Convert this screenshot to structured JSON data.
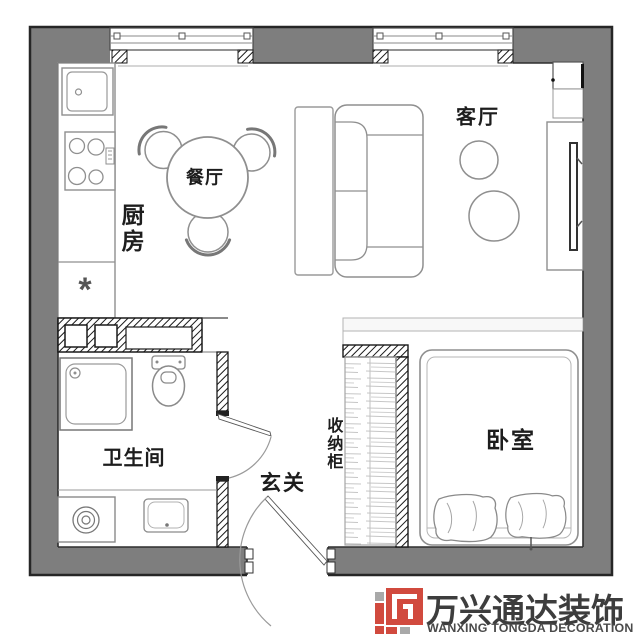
{
  "floorplan": {
    "rooms": {
      "dining": {
        "label": "餐厅"
      },
      "kitchen": {
        "label": "厨房",
        "orientation": "vertical"
      },
      "living": {
        "label": "客厅"
      },
      "bathroom": {
        "label": "卫生间"
      },
      "entry": {
        "label": "玄关"
      },
      "closet": {
        "label": "收纳柜",
        "orientation": "vertical"
      },
      "bedroom": {
        "label": "卧室"
      }
    },
    "symbols": {
      "kitchen_asterisk": "*"
    },
    "colors": {
      "wall_fill": "#7e7e7e",
      "wall_outline": "#2b2b2b",
      "furniture_line": "#8f8f8f",
      "hatch_line": "#1a1a1a",
      "label_text": "#1d1d1d"
    }
  },
  "watermark": {
    "brand_cn": "万兴通达装饰",
    "brand_en": "WANXING TONGDA DECORATION",
    "colors": {
      "red": "#d14a3e",
      "gray": "#a9a9a9",
      "text": "#3d3d3d"
    }
  }
}
